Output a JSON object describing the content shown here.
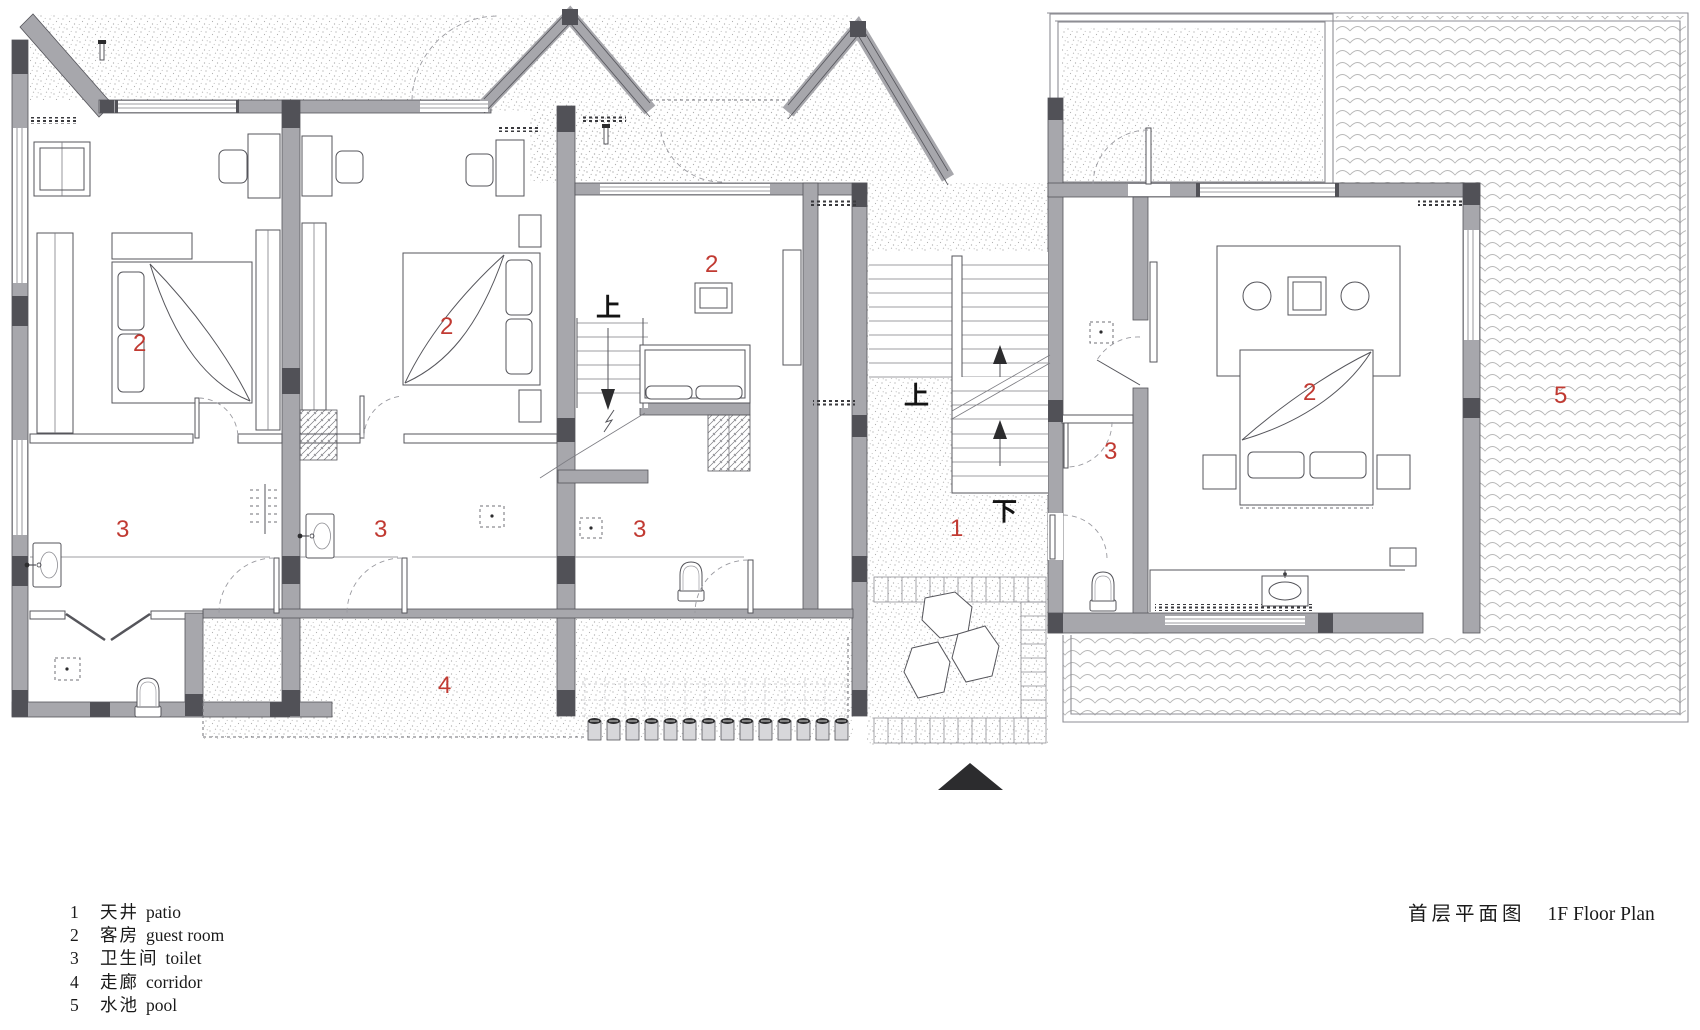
{
  "document": {
    "kind": "architectural floor plan drawing"
  },
  "title": {
    "zh": "首层平面图",
    "en": "1F Floor Plan"
  },
  "legend": {
    "items": [
      {
        "num": "1",
        "zh": "天井",
        "en": "patio"
      },
      {
        "num": "2",
        "zh": "客房",
        "en": "guest room"
      },
      {
        "num": "3",
        "zh": "卫生间",
        "en": "toilet"
      },
      {
        "num": "4",
        "zh": "走廊",
        "en": "corridor"
      },
      {
        "num": "5",
        "zh": "水池",
        "en": "pool"
      }
    ]
  },
  "plan": {
    "room_labels": [
      {
        "room": "patio",
        "text": "1"
      },
      {
        "room": "guest-room-a",
        "text": "2"
      },
      {
        "room": "guest-room-b",
        "text": "2"
      },
      {
        "room": "guest-room-c",
        "text": "2"
      },
      {
        "room": "guest-room-d",
        "text": "2"
      },
      {
        "room": "toilet-a",
        "text": "3"
      },
      {
        "room": "toilet-b",
        "text": "3"
      },
      {
        "room": "toilet-c",
        "text": "3"
      },
      {
        "room": "toilet-d",
        "text": "3"
      },
      {
        "room": "corridor",
        "text": "4"
      },
      {
        "room": "pool",
        "text": "5"
      }
    ],
    "stair_labels": [
      {
        "meaning": "up",
        "text": "上"
      },
      {
        "meaning": "up",
        "text": "上"
      },
      {
        "meaning": "down",
        "text": "下"
      }
    ],
    "colors": {
      "wall_fill": "#a7a7ac",
      "column_fill": "#515157",
      "line": "#55555b",
      "room_number_red": "#c13a32",
      "texture_gray": "#ababab",
      "wave_gray": "#b8b8b8"
    }
  }
}
